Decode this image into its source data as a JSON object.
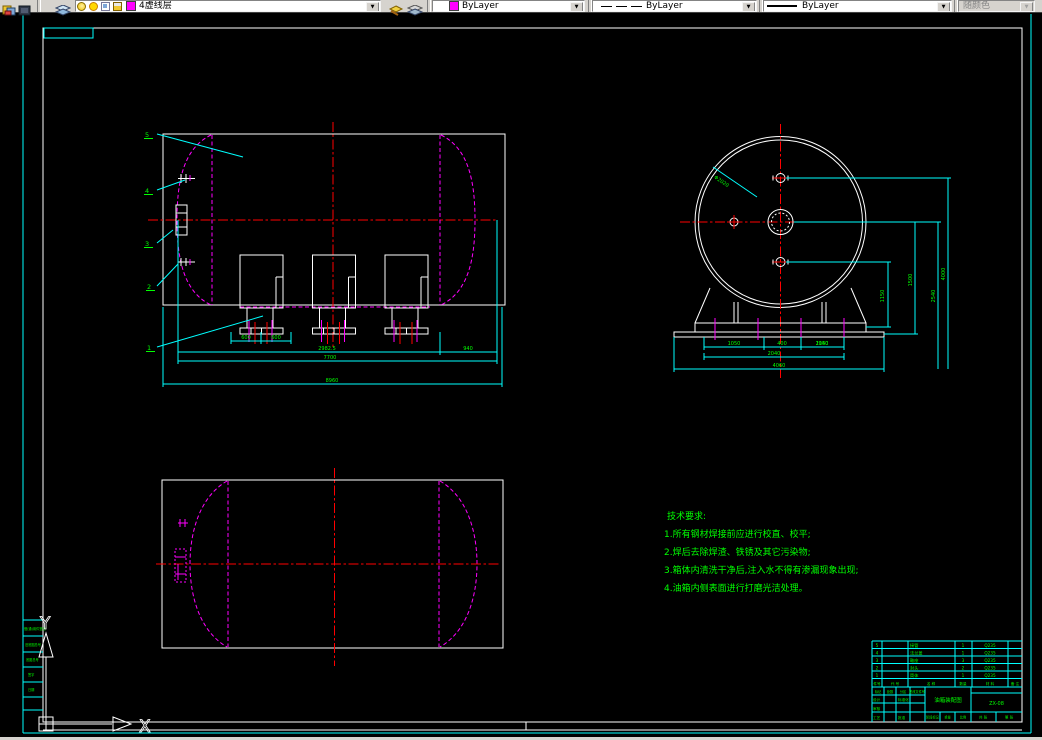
{
  "toolbar": {
    "layer_combo": {
      "value": "4虚线层",
      "swatch_color": "#ff00ff"
    },
    "color_combo": {
      "value": "ByLayer",
      "swatch_color": "#ff00ff"
    },
    "linetype_combo": {
      "value": "ByLayer"
    },
    "lineweight_combo": {
      "value": "ByLayer"
    },
    "plotstyle_combo": {
      "value": "随颜色"
    }
  },
  "colors": {
    "frame": "#ffffff",
    "border": "#00ffff",
    "centerline": "#ff0000",
    "outline": "#ff00ff",
    "text": "#00ff00"
  },
  "ucs": {
    "x": "X",
    "y": "Y"
  },
  "balloons": {
    "b1": "1",
    "b2": "2",
    "b3": "3",
    "b4": "4",
    "b5": "5"
  },
  "front_dims": {
    "d600a": "600",
    "d600b": "600",
    "dmid": "2982.5",
    "dright": "940",
    "dlen": "7700",
    "dtotal": "8960"
  },
  "end_dims": {
    "leader": "Φ2020",
    "r1a": "1050",
    "r1b": "400",
    "r1c": "1150",
    "r2": "2040",
    "r3": "4060",
    "v1": "1150",
    "v2": "1500",
    "v3": "2540",
    "v4": "4000"
  },
  "notes": {
    "title": "技术要求:",
    "l1": "1.所有钢材焊接前应进行校直、校平;",
    "l2": "2.焊后去除焊渣、铁锈及其它污染物;",
    "l3": "3.箱体内清洗干净后,注入水不得有渗漏现象出现;",
    "l4": "4.油箱内侧表面进行打磨光洁处理。"
  },
  "border_strip": {
    "r1": "借(通)用件登记",
    "r2": "旧底图总号",
    "r3": "底图总号",
    "r4": "签字",
    "r5": "日期"
  },
  "title_block": {
    "bom": {
      "rows": [
        {
          "no": "5",
          "name": "接管",
          "qty": "1",
          "mat": "Q235"
        },
        {
          "no": "4",
          "name": "法兰盖",
          "qty": "1",
          "mat": "Q235"
        },
        {
          "no": "3",
          "name": "鞍座",
          "qty": "3",
          "mat": "Q235"
        },
        {
          "no": "2",
          "name": "封头",
          "qty": "2",
          "mat": "Q235"
        },
        {
          "no": "1",
          "name": "筒体",
          "qty": "1",
          "mat": "Q235"
        }
      ],
      "header": {
        "no": "件号",
        "code": "代 号",
        "name": "名 称",
        "qty": "数量",
        "mat": "材 料",
        "note": "备 注"
      }
    },
    "sign": {
      "h1": "标记",
      "h2": "处数",
      "h3": "分区",
      "h4": "更改文件号",
      "r1a": "设计",
      "r1b": "标准化",
      "r2a": "审核",
      "r3a": "工艺",
      "r3b": "批准"
    },
    "title": "油箱装配图",
    "no": "ZX-08",
    "stage": {
      "a": "阶段标记",
      "b": "重量",
      "c": "比例"
    },
    "sheet": {
      "a": "共 张",
      "b": "第 张"
    }
  }
}
